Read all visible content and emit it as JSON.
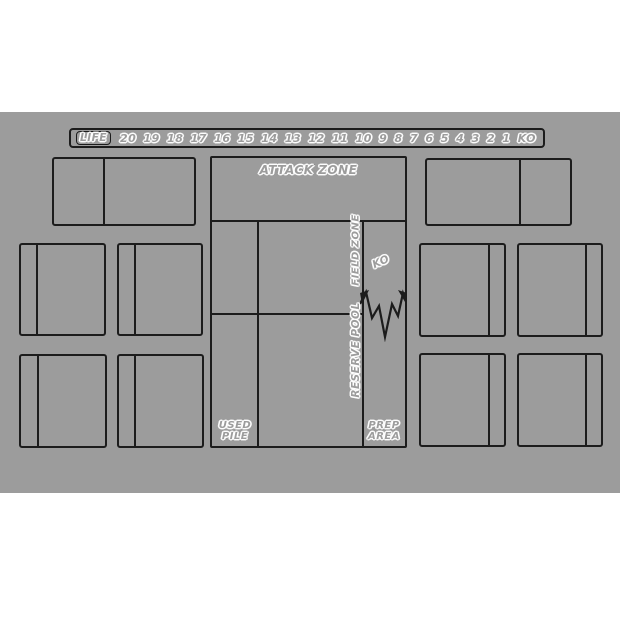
{
  "colors": {
    "page-background": "#ffffff",
    "mat-background": "#9c9c9c",
    "line-color": "#1c1c1c"
  },
  "life_track": {
    "label": "LIFE",
    "values": [
      "20",
      "19",
      "18",
      "17",
      "16",
      "15",
      "14",
      "13",
      "12",
      "11",
      "10",
      "9",
      "8",
      "7",
      "6",
      "5",
      "4",
      "3",
      "2",
      "1",
      "KO"
    ]
  },
  "zones": {
    "attack_zone": "ATTACK ZONE",
    "field_zone": "FIELD ZONE",
    "reserve_pool": "RESERVE POOL",
    "ko": "KO",
    "used_pile": [
      "USED",
      "PILE"
    ],
    "prep_area": [
      "PREP",
      "AREA"
    ]
  }
}
